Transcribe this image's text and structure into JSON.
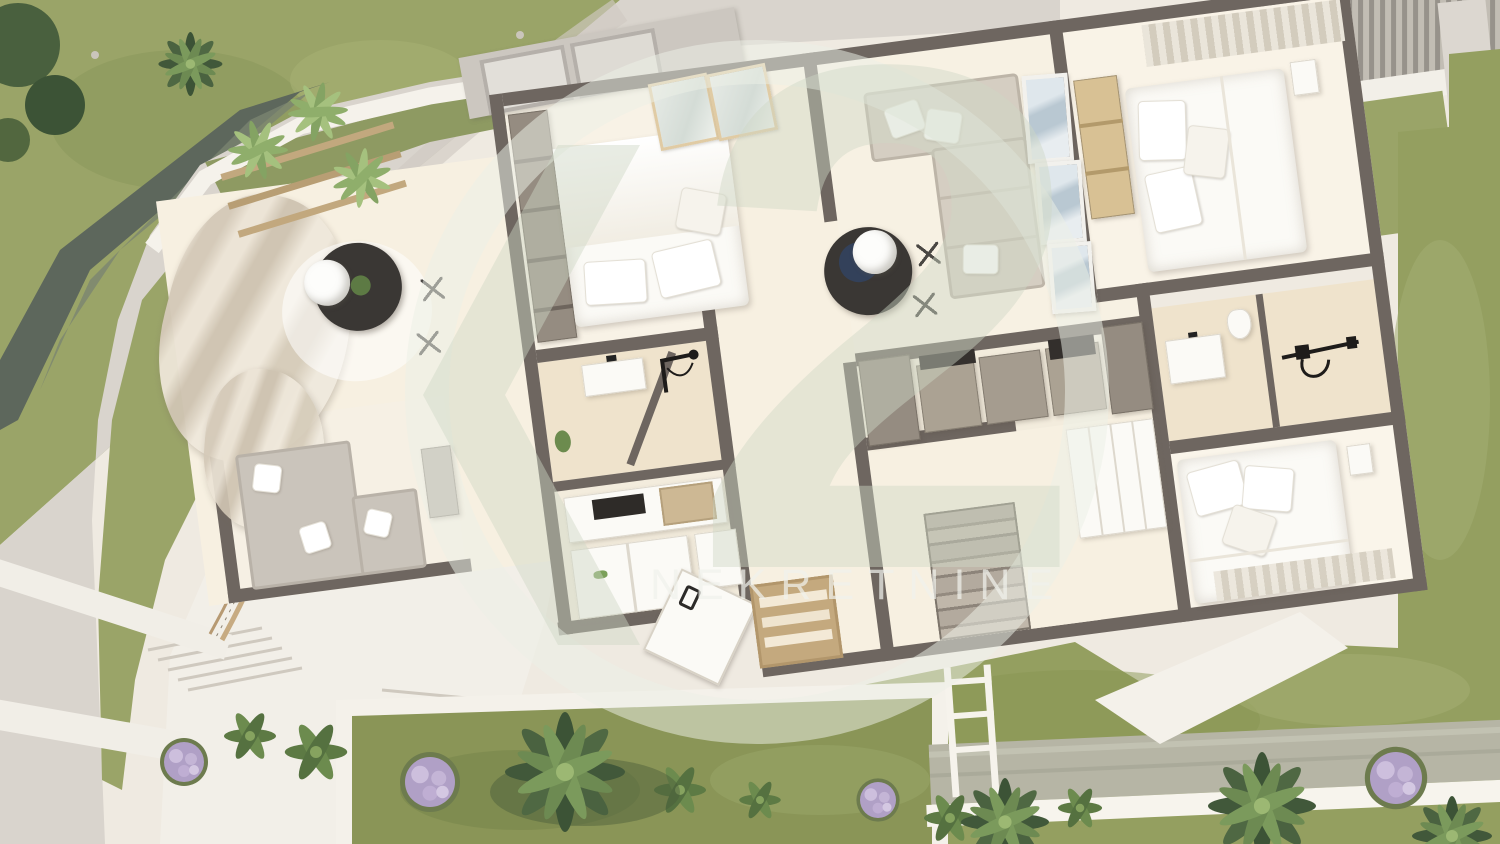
{
  "watermark": {
    "brand": "K2",
    "numeral": "2",
    "label": "NEKRETNINE"
  },
  "colors": {
    "base": "#efeae1",
    "wall": "#6e6660",
    "floor": "#f7f0e1",
    "floorWarm": "#efe3cc",
    "white": "#fbfaf6",
    "plaza": "#f2efe8",
    "path": "#d9d4cd",
    "grass": "#9aa468",
    "grassDark": "#7f8c52",
    "grassBottom": "#949f60",
    "planterGrass": "#8a9557",
    "stream": "#5d675c",
    "water": "#b6b5a5",
    "deck": "#e7e0d2",
    "wood": "#c4a97e",
    "woodLight": "#e0cba4",
    "sofaGrey": "#cac4bb",
    "sofaBeige": "#d5cec2",
    "cabinet": "#aba293",
    "cabinetDark": "#958c81",
    "tan": "#d8c194",
    "dark": "#3a3734",
    "navy": "#33415a",
    "art": "#c5d0d8",
    "foliage": "#49603e",
    "foliageLight": "#86a35f",
    "lavender": "#b0a0c6",
    "wm": "rgba(236,240,231,0.52)",
    "wmShape": "rgba(206,215,197,0.45)",
    "wmText": "rgba(240,241,235,0.72)"
  },
  "scene": {
    "type": "aerial-3d-floor-plan-render",
    "rooms": [
      "terrace",
      "bedroom-1",
      "bathroom-1",
      "kitchenette",
      "hall",
      "living-room",
      "kitchen",
      "stairwell",
      "bedroom-2",
      "bathroom-2",
      "bedroom-3",
      "lounge-corner"
    ],
    "outdoor": [
      "curved-path",
      "stream",
      "garden-lawn",
      "planter-beds",
      "pool",
      "pergola",
      "outdoor-stairs",
      "wood-deck",
      "palms",
      "lavender-bushes"
    ]
  }
}
